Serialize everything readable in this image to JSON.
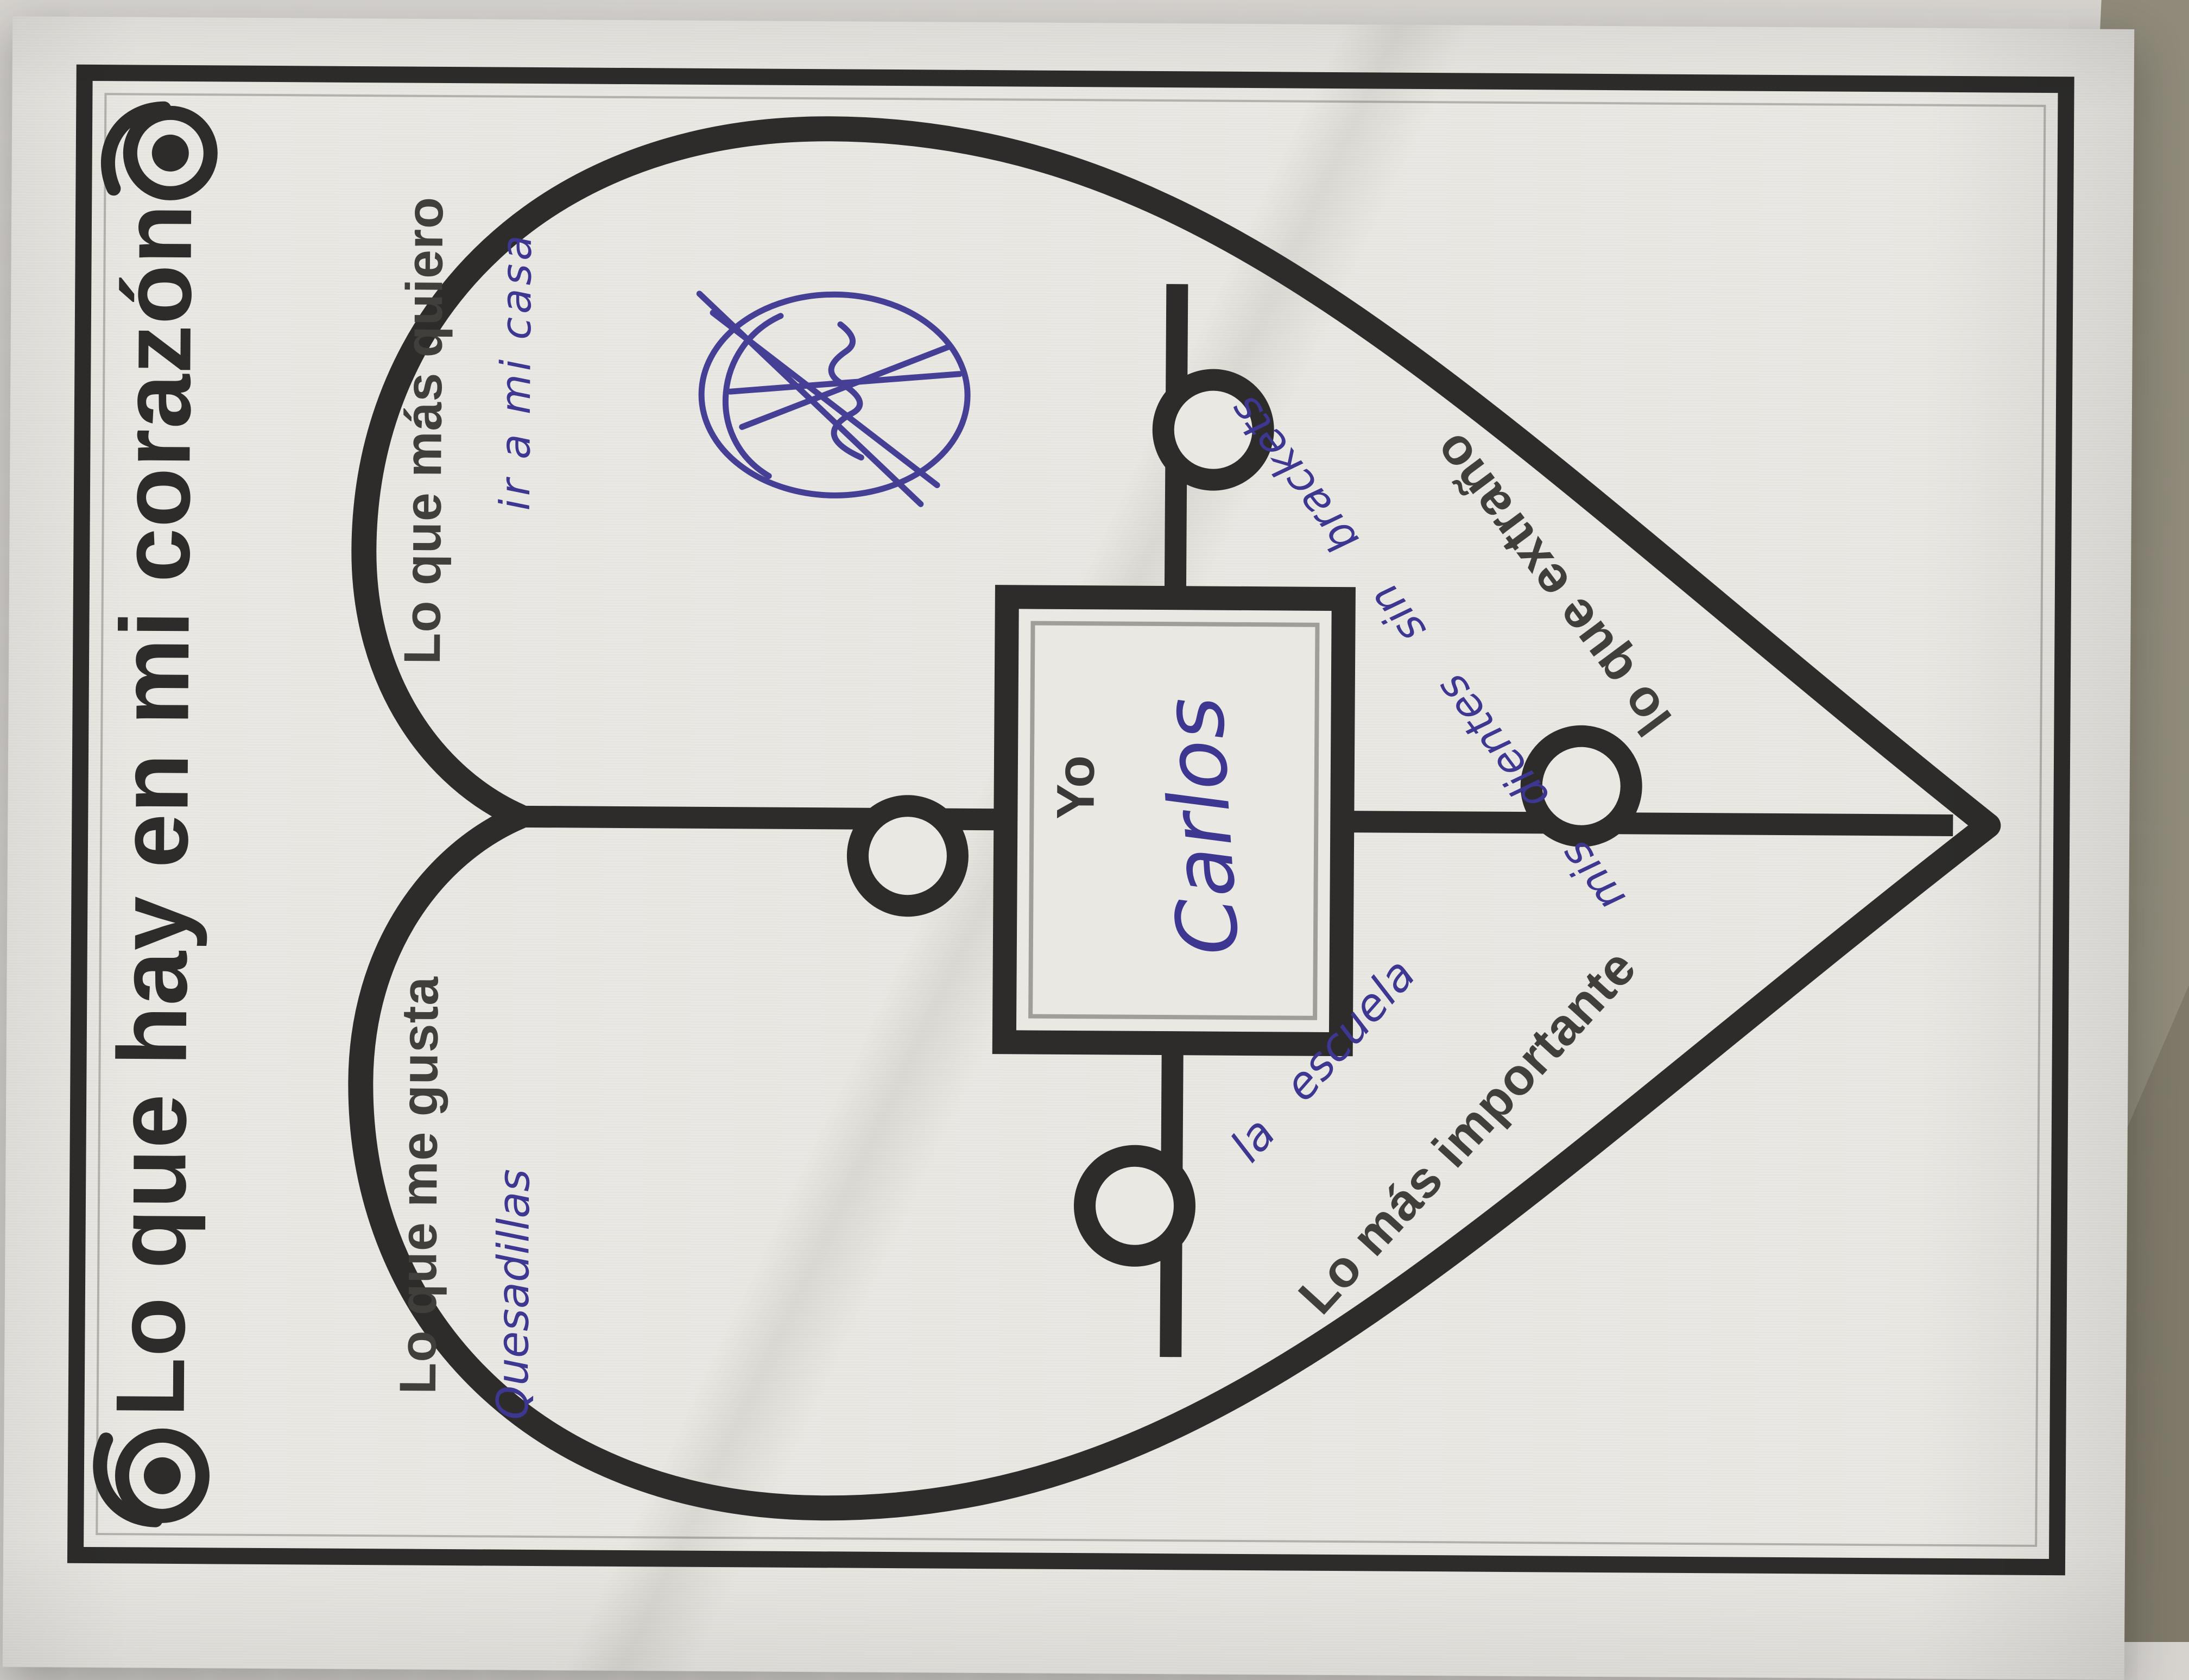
{
  "photo": {
    "surface_color": "#d6d3cf",
    "table_color": "#8f8a7a",
    "paper_color": "#eae8e3",
    "frame_color": "#2d2c2a",
    "print_ink_color": "#403f3c",
    "pen_ink_color": "#3d3791"
  },
  "worksheet": {
    "title": "Lo que hay en mi corazón",
    "center_label": "Yo",
    "center_name": "Carlos",
    "sections": [
      {
        "position": "top-left",
        "label": "Lo que me gusta",
        "answer": "Quesadillas"
      },
      {
        "position": "top-right",
        "label": "Lo que más quiero",
        "answer": "ir a mi casa"
      },
      {
        "position": "bottom-left",
        "label": "Lo más importante",
        "answer": "la escuela"
      },
      {
        "position": "bottom-right",
        "label": "lo que extraño",
        "answer": "mis dientes sin brackets"
      }
    ],
    "decorations": [
      "corner-spiral-ornament-left",
      "corner-spiral-ornament-right",
      "heart-puzzle-outline",
      "center-puzzle-square",
      "pen-scribble"
    ]
  }
}
